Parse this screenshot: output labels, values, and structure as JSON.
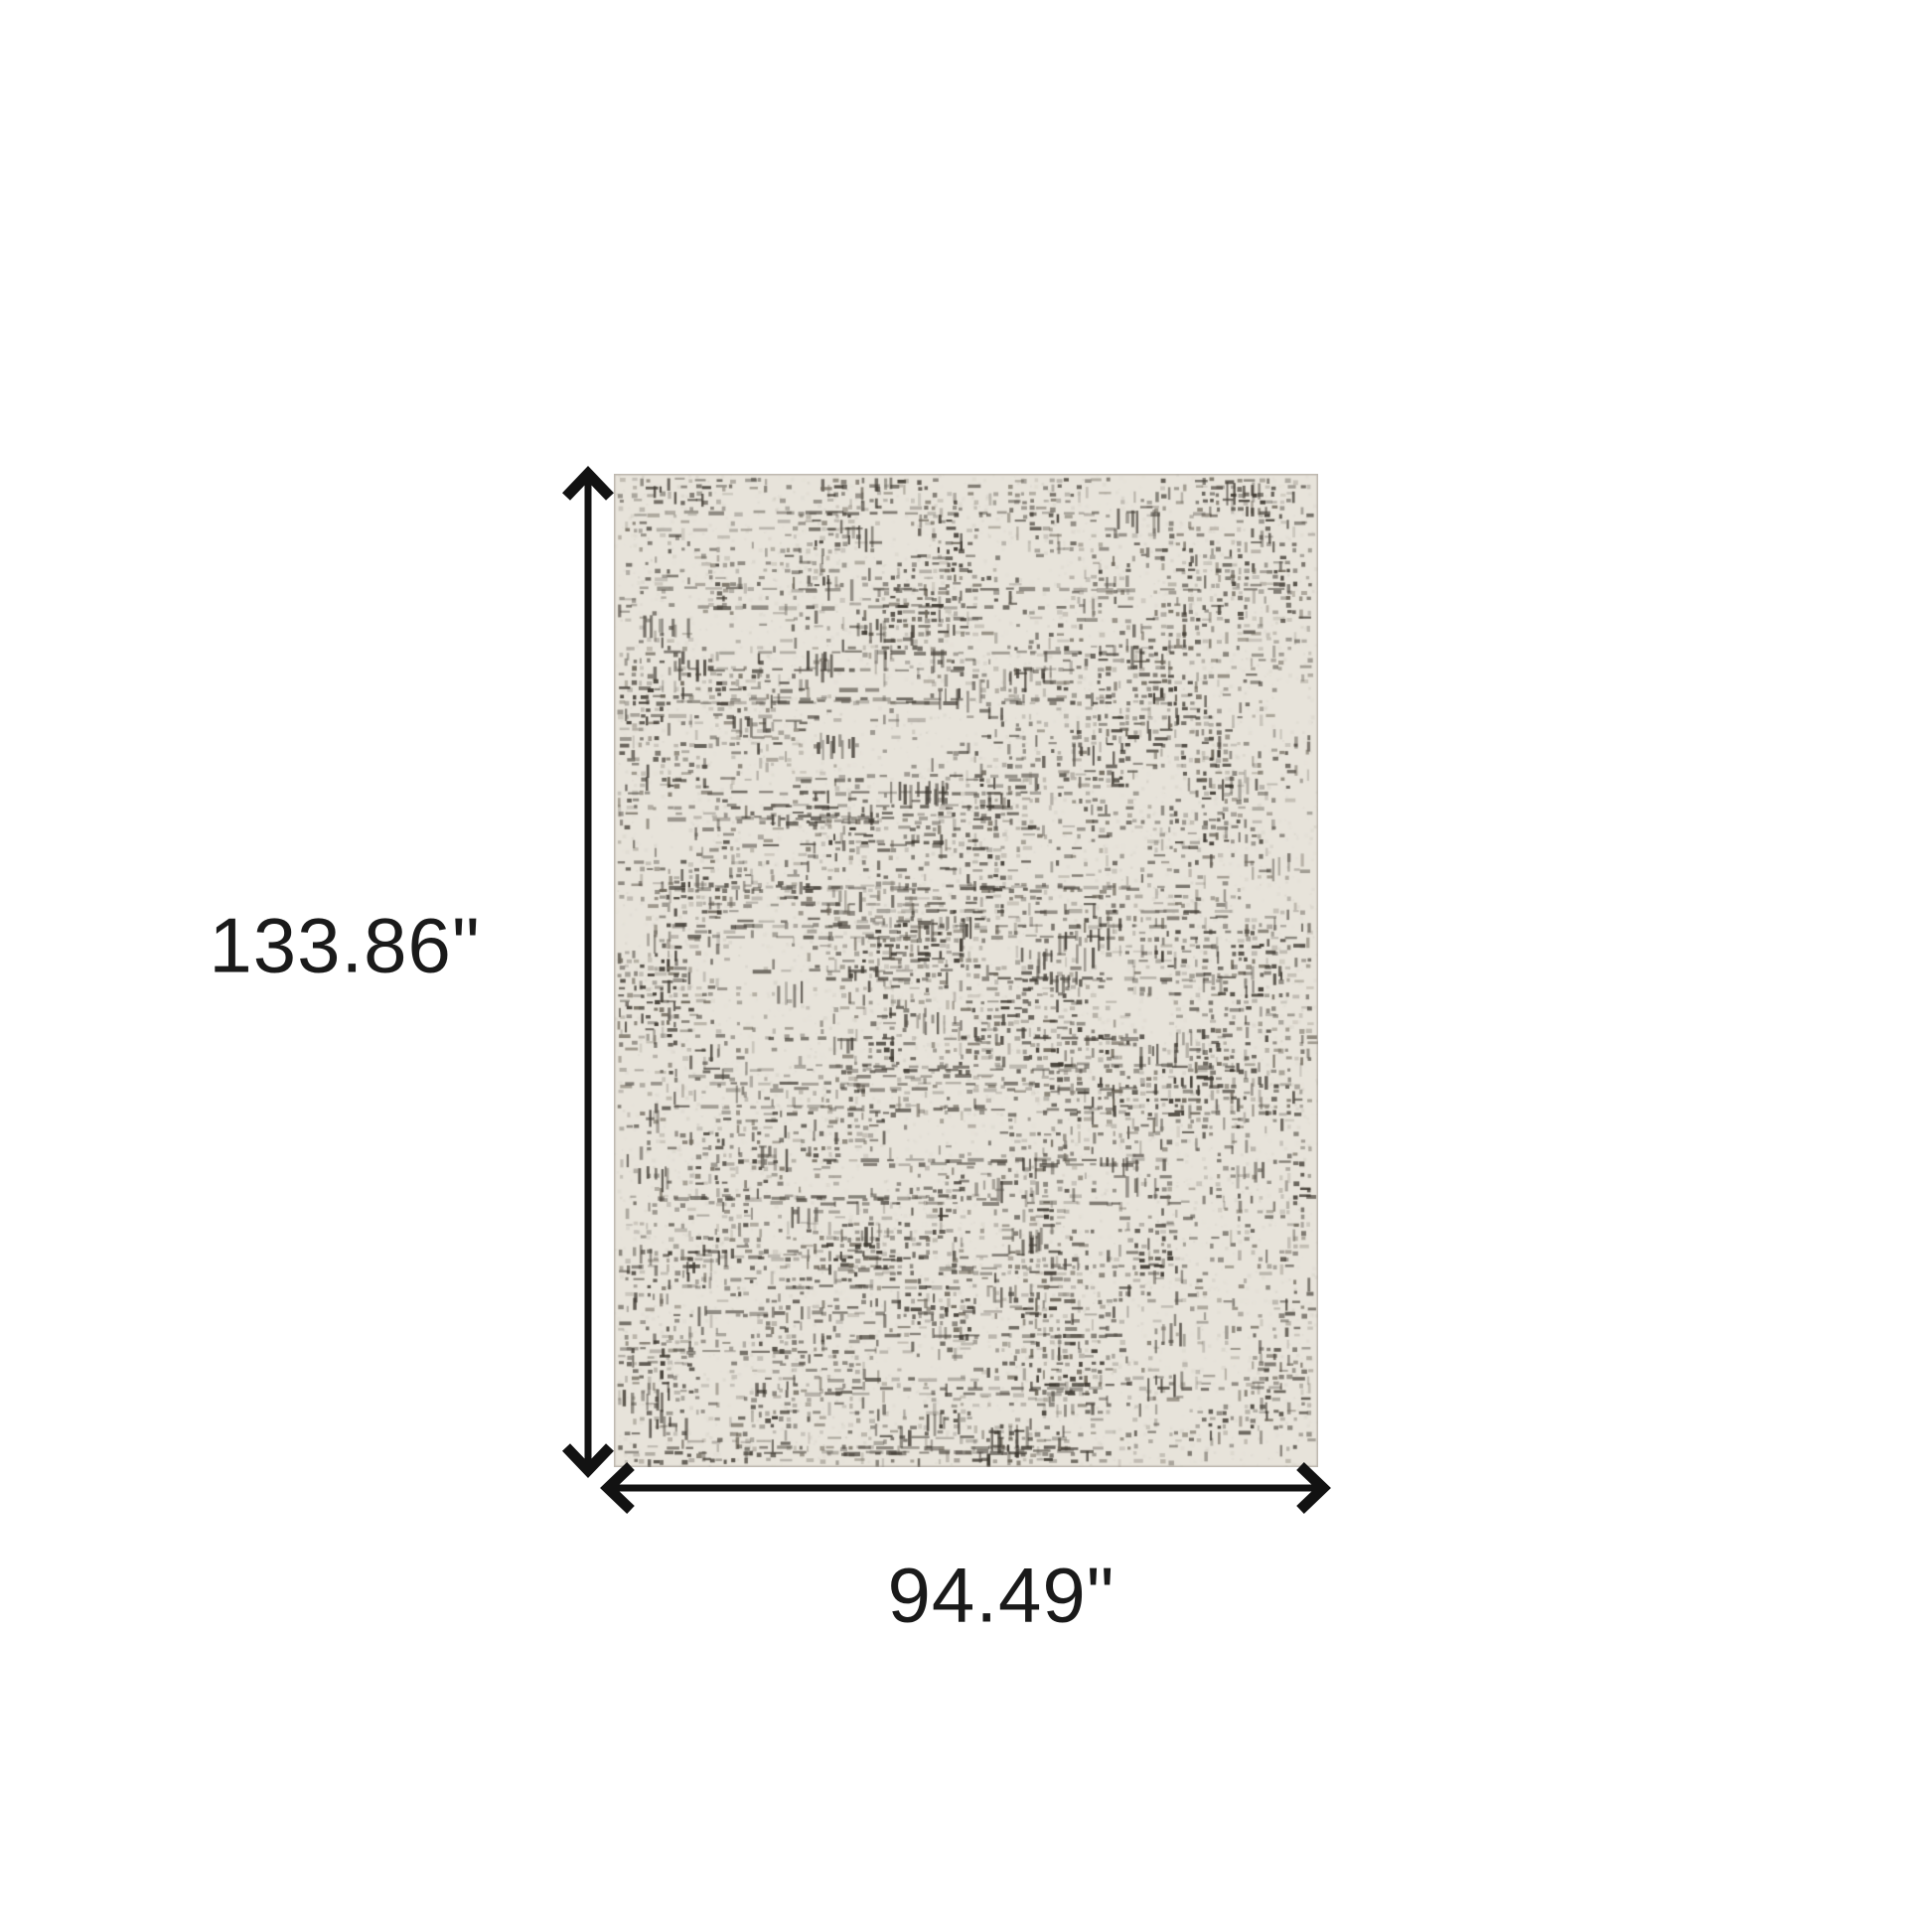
{
  "canvas": {
    "background_color": "#ffffff"
  },
  "labels": {
    "height": "133.86\"",
    "width": "94.49\""
  },
  "style": {
    "annotation_color": "#121212",
    "label_color": "#1a1a1a",
    "rug_base_color": "#e7e3da",
    "rug_pattern_dark": "#3f3a32",
    "rug_pattern_mid": "#6e675a",
    "rug_edge_color": "#9a948a"
  }
}
